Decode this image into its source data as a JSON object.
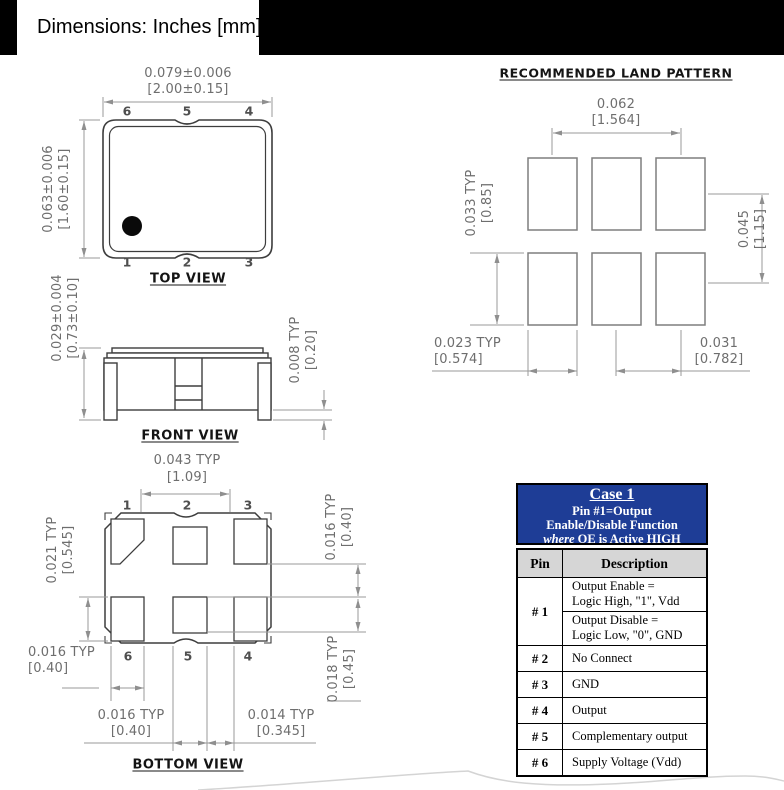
{
  "header": {
    "title": "Dimensions: Inches [mm]"
  },
  "colors": {
    "table_header_bg": "#1E3D96",
    "outline": "#3D3D3D",
    "dim_line": "#8F8F8F",
    "dim_text": "#6E6E6E"
  },
  "top_view": {
    "label": "TOP VIEW",
    "pins_top": [
      "6",
      "5",
      "4"
    ],
    "pins_bottom": [
      "1",
      "2",
      "3"
    ],
    "width": {
      "in": "0.079±0.006",
      "mm": "[2.00±0.15]"
    },
    "height": {
      "in": "0.063±0.006",
      "mm": "[1.60±0.15]"
    }
  },
  "front_view": {
    "label": "FRONT VIEW",
    "height": {
      "in": "0.029±0.004",
      "mm": "[0.73±0.10]"
    },
    "standoff": {
      "in": "0.008 TYP",
      "mm": "[0.20]"
    }
  },
  "bottom_view": {
    "label": "BOTTOM VIEW",
    "pins_top": [
      "1",
      "2",
      "3"
    ],
    "pins_bottom": [
      "6",
      "5",
      "4"
    ],
    "pad_pitch": {
      "in": "0.043 TYP",
      "mm": "[1.09]"
    },
    "corner_pad_height": {
      "in": "0.021  TYP",
      "mm": "[0.545]"
    },
    "row_gap": {
      "in": "0.016 TYP",
      "mm": "[0.40]"
    },
    "center_pad_height": {
      "in": "0.018 TYP",
      "mm": "[0.45]"
    },
    "corner_pad_width": {
      "in": "0.016 TYP",
      "mm": "[0.40]"
    },
    "center_pad_width": {
      "in": "0.016 TYP",
      "mm": "[0.40]"
    },
    "pad_gap": {
      "in": "0.014  TYP",
      "mm": "[0.345]"
    }
  },
  "land_pattern": {
    "title": "RECOMMENDED LAND PATTERN",
    "pad_span": {
      "in": "0.062",
      "mm": "[1.564]"
    },
    "pad_height": {
      "in": "0.033 TYP",
      "mm": "[0.85]"
    },
    "row_pitch": {
      "in": "0.045",
      "mm": "[1.15]"
    },
    "pad_width": {
      "in": "0.023  TYP",
      "mm": "[0.574]"
    },
    "col_pitch": {
      "in": "0.031",
      "mm": "[0.782]"
    }
  },
  "pin_table": {
    "case_title": "Case 1",
    "case_line1": "Pin #1=Output",
    "case_line2": "Enable/Disable Function",
    "case_line3_em": "where",
    "case_line3_rest": " OE is Active HIGH",
    "col_pin": "Pin",
    "col_desc": "Description",
    "rows": [
      {
        "pin": "# 1",
        "desc_top_1": "Output Enable =",
        "desc_top_2": "Logic High, \"1\", Vdd",
        "desc_bot_1": "Output Disable =",
        "desc_bot_2": "Logic Low, \"0\", GND"
      },
      {
        "pin": "# 2",
        "desc": "No Connect"
      },
      {
        "pin": "# 3",
        "desc": "GND"
      },
      {
        "pin": "# 4",
        "desc": "Output"
      },
      {
        "pin": "# 5",
        "desc": "Complementary output"
      },
      {
        "pin": "# 6",
        "desc": "Supply Voltage (Vdd)"
      }
    ]
  }
}
